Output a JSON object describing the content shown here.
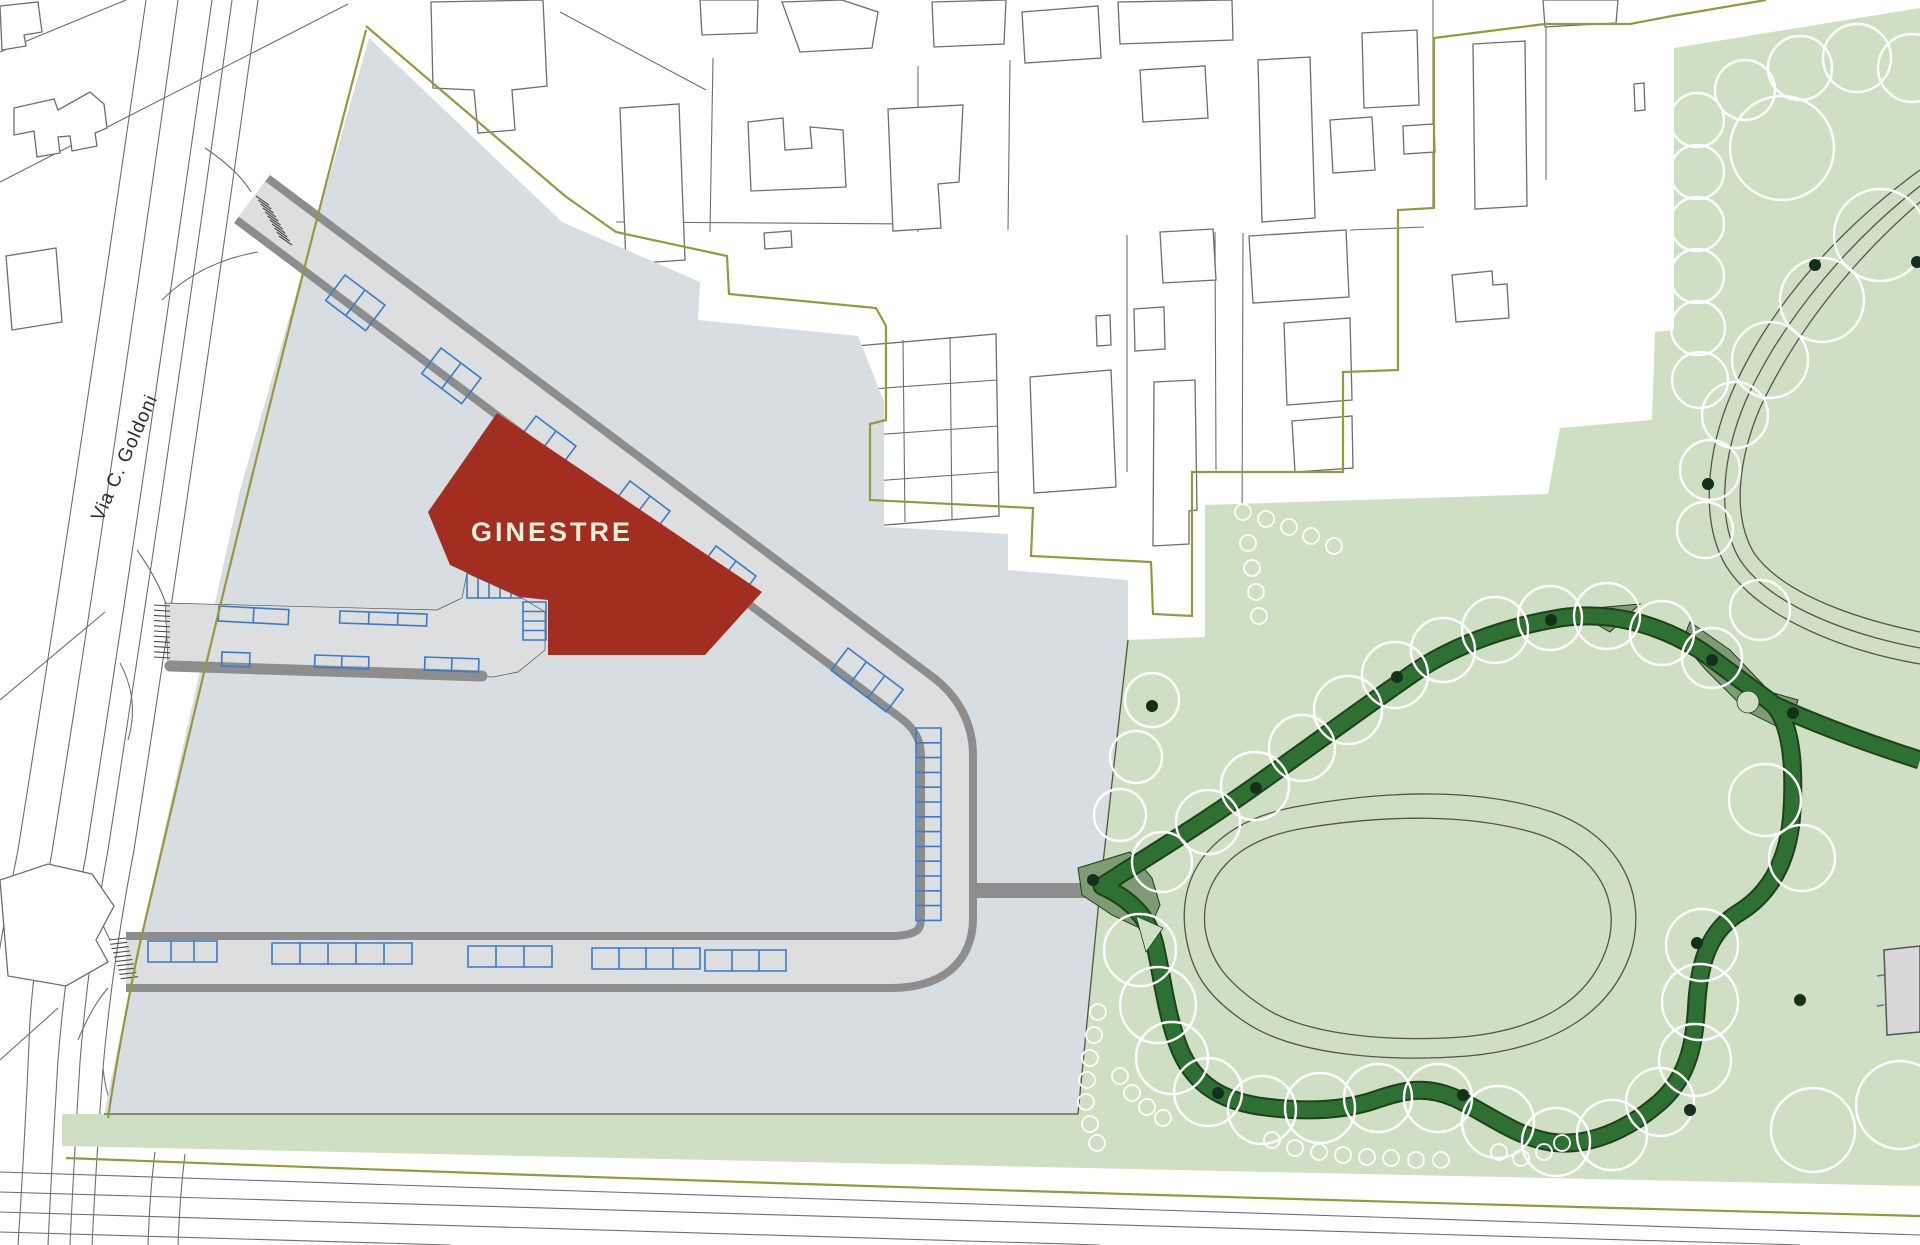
{
  "labels": {
    "building": "GINESTRE",
    "street": "Via C. Goldoni"
  },
  "colors": {
    "site": "#d7dde1",
    "road_fill": "#dcdee0",
    "road_casing": "#8d8d8d",
    "park": "#cfdfc3",
    "path_dark": "#2e7031",
    "path_dark_edge": "#1d401d",
    "path_mid": "#7d9b74",
    "stall": "#3a7ac8",
    "line": "#6e6e6e",
    "olive": "#97983c",
    "thin": "#55544a",
    "red": "#a22d21",
    "cream": "#e9eed9",
    "trunk": "#15301a",
    "gray_bld": "#d8d8d8"
  },
  "map": {
    "trees": [
      [
        1162,
        862,
        30
      ],
      [
        1208,
        822,
        32
      ],
      [
        1255,
        786,
        34
      ],
      [
        1302,
        748,
        33
      ],
      [
        1348,
        710,
        34
      ],
      [
        1395,
        675,
        33
      ],
      [
        1443,
        650,
        32
      ],
      [
        1495,
        630,
        33
      ],
      [
        1550,
        618,
        32
      ],
      [
        1607,
        616,
        33
      ],
      [
        1662,
        633,
        32
      ],
      [
        1712,
        658,
        30
      ],
      [
        1152,
        700,
        27
      ],
      [
        1136,
        757,
        26
      ],
      [
        1120,
        815,
        26
      ],
      [
        1140,
        950,
        36
      ],
      [
        1158,
        1005,
        38
      ],
      [
        1172,
        1058,
        36
      ],
      [
        1208,
        1092,
        34
      ],
      [
        1262,
        1110,
        34
      ],
      [
        1320,
        1108,
        35
      ],
      [
        1378,
        1098,
        34
      ],
      [
        1438,
        1098,
        34
      ],
      [
        1498,
        1122,
        36
      ],
      [
        1556,
        1142,
        34
      ],
      [
        1612,
        1135,
        35
      ],
      [
        1660,
        1102,
        34
      ],
      [
        1695,
        1060,
        36
      ],
      [
        1700,
        1002,
        38
      ],
      [
        1702,
        945,
        36
      ],
      [
        1765,
        800,
        36
      ],
      [
        1802,
        858,
        33
      ],
      [
        1880,
        235,
        46
      ],
      [
        1822,
        300,
        42
      ],
      [
        1770,
        360,
        38
      ],
      [
        1735,
        415,
        33
      ],
      [
        1710,
        470,
        30
      ],
      [
        1705,
        530,
        28
      ],
      [
        1760,
        610,
        30
      ],
      [
        1745,
        90,
        30
      ],
      [
        1800,
        68,
        32
      ],
      [
        1857,
        58,
        34
      ],
      [
        1912,
        68,
        34
      ],
      [
        1697,
        120,
        27
      ],
      [
        1697,
        172,
        27
      ],
      [
        1697,
        224,
        27
      ],
      [
        1697,
        276,
        27
      ],
      [
        1698,
        328,
        27
      ],
      [
        1700,
        380,
        28
      ],
      [
        1782,
        148,
        52
      ],
      [
        1813,
        1130,
        42
      ],
      [
        1900,
        1105,
        44
      ]
    ],
    "shrubs": [
      [
        1098,
        1012
      ],
      [
        1094,
        1035
      ],
      [
        1090,
        1058
      ],
      [
        1087,
        1080
      ],
      [
        1086,
        1102
      ],
      [
        1090,
        1124
      ],
      [
        1097,
        1143
      ],
      [
        1120,
        1076
      ],
      [
        1132,
        1093
      ],
      [
        1147,
        1107
      ],
      [
        1163,
        1118
      ],
      [
        1272,
        1140
      ],
      [
        1295,
        1148
      ],
      [
        1319,
        1152
      ],
      [
        1343,
        1155
      ],
      [
        1367,
        1157
      ],
      [
        1391,
        1158
      ],
      [
        1416,
        1160
      ],
      [
        1441,
        1160
      ],
      [
        1499,
        1152
      ],
      [
        1521,
        1158
      ],
      [
        1544,
        1152
      ],
      [
        1562,
        1143
      ],
      [
        1243,
        512
      ],
      [
        1266,
        519
      ],
      [
        1289,
        527
      ],
      [
        1311,
        536
      ],
      [
        1334,
        546
      ],
      [
        1248,
        543
      ],
      [
        1252,
        568
      ],
      [
        1256,
        592
      ],
      [
        1259,
        616
      ]
    ],
    "trunks": [
      [
        1152,
        706
      ],
      [
        1256,
        788
      ],
      [
        1397,
        677
      ],
      [
        1551,
        620
      ],
      [
        1712,
        660
      ],
      [
        1793,
        713
      ],
      [
        1800,
        1000
      ],
      [
        1697,
        943
      ],
      [
        1463,
        1095
      ],
      [
        1218,
        1093
      ],
      [
        1093,
        880
      ],
      [
        1815,
        265
      ],
      [
        1917,
        262
      ],
      [
        1708,
        484
      ],
      [
        1690,
        1110
      ]
    ],
    "parking_groups": [
      {
        "x": 345,
        "y": 275,
        "a": 37,
        "n": 2,
        "w": 25,
        "d": 32
      },
      {
        "x": 441,
        "y": 348,
        "a": 37,
        "n": 2,
        "w": 25,
        "d": 32
      },
      {
        "x": 536,
        "y": 416,
        "a": 37,
        "n": 2,
        "w": 25,
        "d": 32
      },
      {
        "x": 630,
        "y": 481,
        "a": 37,
        "n": 2,
        "w": 25,
        "d": 32
      },
      {
        "x": 716,
        "y": 546,
        "a": 37,
        "n": 2,
        "w": 25,
        "d": 32
      },
      {
        "x": 848,
        "y": 648,
        "a": 37,
        "n": 3,
        "w": 23,
        "d": 28
      },
      {
        "x": 941,
        "y": 728,
        "a": 90,
        "n": 13,
        "w": 14.8,
        "d": 25
      },
      {
        "x": 148,
        "y": 941,
        "a": 0,
        "n": 3,
        "w": 23,
        "d": 21
      },
      {
        "x": 272,
        "y": 943,
        "a": 0,
        "n": 5,
        "w": 28,
        "d": 21
      },
      {
        "x": 468,
        "y": 946,
        "a": 0,
        "n": 3,
        "w": 28,
        "d": 21
      },
      {
        "x": 592,
        "y": 948,
        "a": 0,
        "n": 4,
        "w": 27,
        "d": 21
      },
      {
        "x": 705,
        "y": 950,
        "a": 0,
        "n": 3,
        "w": 27,
        "d": 21
      },
      {
        "x": 219,
        "y": 606,
        "a": 3,
        "n": 2,
        "w": 35,
        "d": 15
      },
      {
        "x": 340,
        "y": 611,
        "a": 2,
        "n": 3,
        "w": 29,
        "d": 12
      },
      {
        "x": 222,
        "y": 652,
        "a": 2,
        "n": 1,
        "w": 28,
        "d": 14
      },
      {
        "x": 315,
        "y": 655,
        "a": 2,
        "n": 2,
        "w": 27,
        "d": 12
      },
      {
        "x": 425,
        "y": 657,
        "a": 2,
        "n": 2,
        "w": 27,
        "d": 13
      },
      {
        "x": 467,
        "y": 573,
        "a": 0,
        "n": 5,
        "w": 11,
        "d": 25
      },
      {
        "x": 546,
        "y": 602,
        "a": 90,
        "n": 4,
        "w": 9.5,
        "d": 23
      }
    ],
    "hatches": [
      {
        "x": 256,
        "y": 196,
        "dx": 2.3,
        "dy": 4.0,
        "n": 11,
        "lx": 13,
        "ly": 9
      },
      {
        "x": 154,
        "y": 605,
        "dx": 0,
        "dy": 5.2,
        "n": 11,
        "lx": 16,
        "ly": 1
      },
      {
        "x": 109,
        "y": 940,
        "dx": 1.3,
        "dy": 4.3,
        "n": 10,
        "lx": 17,
        "ly": -2
      }
    ]
  }
}
